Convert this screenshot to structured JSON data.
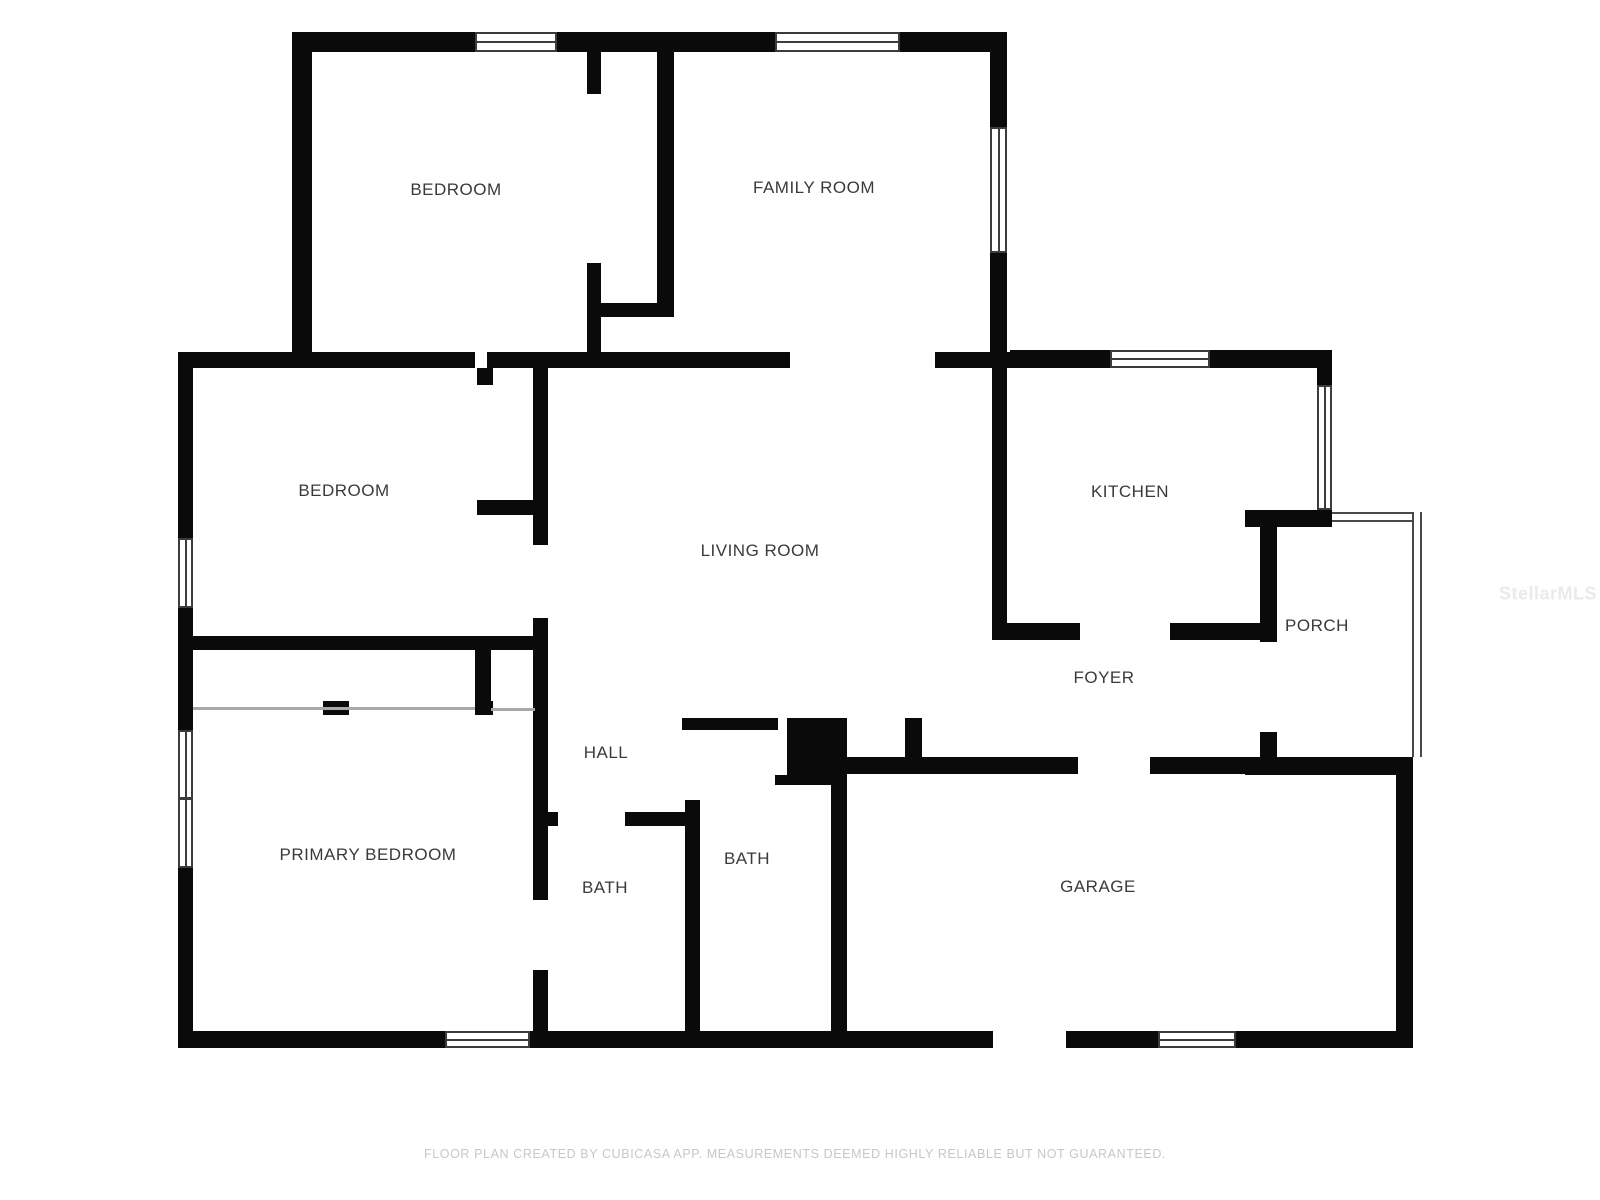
{
  "meta": {
    "app": "floor-plan",
    "creator_note": "FLOOR PLAN CREATED BY CUBICASA APP. MEASUREMENTS DEEMED HIGHLY RELIABLE BUT NOT GUARANTEED.",
    "watermark_text": "StellarMLS"
  },
  "colors": {
    "wall": "#0a0a0a",
    "window_outline": "#3c3c3c",
    "thin_line": "#a8a8a8",
    "label": "#3a3a3a",
    "footer": "#c7c7c7",
    "watermark": "#eaeaea",
    "background": "#ffffff"
  },
  "rooms": [
    {
      "id": "bedroom-top",
      "label": "BEDROOM",
      "cx": 456,
      "cy": 190
    },
    {
      "id": "family-room",
      "label": "FAMILY ROOM",
      "cx": 814,
      "cy": 188
    },
    {
      "id": "bedroom-mid",
      "label": "BEDROOM",
      "cx": 344,
      "cy": 491
    },
    {
      "id": "living-room",
      "label": "LIVING ROOM",
      "cx": 760,
      "cy": 551
    },
    {
      "id": "kitchen",
      "label": "KITCHEN",
      "cx": 1130,
      "cy": 492
    },
    {
      "id": "porch",
      "label": "PORCH",
      "cx": 1317,
      "cy": 626
    },
    {
      "id": "foyer",
      "label": "FOYER",
      "cx": 1104,
      "cy": 678
    },
    {
      "id": "hall",
      "label": "HALL",
      "cx": 606,
      "cy": 753
    },
    {
      "id": "primary-bedroom",
      "label": "PRIMARY BEDROOM",
      "cx": 368,
      "cy": 855
    },
    {
      "id": "bath-hall",
      "label": "BATH",
      "cx": 605,
      "cy": 888
    },
    {
      "id": "bath-center",
      "label": "BATH",
      "cx": 747,
      "cy": 859
    },
    {
      "id": "garage",
      "label": "GARAGE",
      "cx": 1098,
      "cy": 887
    }
  ],
  "walls": [
    {
      "x": 292,
      "y": 32,
      "w": 183,
      "h": 20
    },
    {
      "x": 557,
      "y": 32,
      "w": 218,
      "h": 20
    },
    {
      "x": 900,
      "y": 32,
      "w": 107,
      "h": 20
    },
    {
      "x": 292,
      "y": 32,
      "w": 20,
      "h": 330
    },
    {
      "x": 178,
      "y": 352,
      "w": 297,
      "h": 16
    },
    {
      "x": 487,
      "y": 352,
      "w": 303,
      "h": 16
    },
    {
      "x": 935,
      "y": 352,
      "w": 75,
      "h": 16
    },
    {
      "x": 1010,
      "y": 350,
      "w": 100,
      "h": 18
    },
    {
      "x": 1210,
      "y": 350,
      "w": 122,
      "h": 18
    },
    {
      "x": 178,
      "y": 352,
      "w": 15,
      "h": 186
    },
    {
      "x": 178,
      "y": 608,
      "w": 15,
      "h": 122
    },
    {
      "x": 178,
      "y": 868,
      "w": 15,
      "h": 180
    },
    {
      "x": 178,
      "y": 1031,
      "w": 267,
      "h": 17
    },
    {
      "x": 530,
      "y": 1031,
      "w": 463,
      "h": 17
    },
    {
      "x": 1066,
      "y": 1031,
      "w": 92,
      "h": 17
    },
    {
      "x": 1236,
      "y": 1031,
      "w": 177,
      "h": 17
    },
    {
      "x": 990,
      "y": 32,
      "w": 17,
      "h": 95
    },
    {
      "x": 990,
      "y": 253,
      "w": 17,
      "h": 115
    },
    {
      "x": 992,
      "y": 368,
      "w": 15,
      "h": 265
    },
    {
      "x": 1317,
      "y": 350,
      "w": 15,
      "h": 35
    },
    {
      "x": 1245,
      "y": 510,
      "w": 87,
      "h": 17
    },
    {
      "x": 992,
      "y": 623,
      "w": 88,
      "h": 17
    },
    {
      "x": 1170,
      "y": 623,
      "w": 93,
      "h": 17
    },
    {
      "x": 1260,
      "y": 522,
      "w": 17,
      "h": 120
    },
    {
      "x": 1260,
      "y": 732,
      "w": 17,
      "h": 26
    },
    {
      "x": 1245,
      "y": 757,
      "w": 168,
      "h": 18
    },
    {
      "x": 845,
      "y": 757,
      "w": 233,
      "h": 17
    },
    {
      "x": 1150,
      "y": 757,
      "w": 95,
      "h": 17
    },
    {
      "x": 831,
      "y": 718,
      "w": 16,
      "h": 313
    },
    {
      "x": 1396,
      "y": 757,
      "w": 17,
      "h": 274
    },
    {
      "x": 682,
      "y": 718,
      "w": 96,
      "h": 12
    },
    {
      "x": 787,
      "y": 718,
      "w": 46,
      "h": 57
    },
    {
      "x": 775,
      "y": 775,
      "w": 58,
      "h": 10
    },
    {
      "x": 905,
      "y": 718,
      "w": 17,
      "h": 39
    },
    {
      "x": 685,
      "y": 800,
      "w": 15,
      "h": 231
    },
    {
      "x": 548,
      "y": 812,
      "w": 10,
      "h": 14
    },
    {
      "x": 625,
      "y": 812,
      "w": 75,
      "h": 14
    },
    {
      "x": 533,
      "y": 368,
      "w": 15,
      "h": 177
    },
    {
      "x": 533,
      "y": 618,
      "w": 15,
      "h": 282
    },
    {
      "x": 533,
      "y": 970,
      "w": 15,
      "h": 61
    },
    {
      "x": 477,
      "y": 368,
      "w": 16,
      "h": 17
    },
    {
      "x": 477,
      "y": 500,
      "w": 68,
      "h": 15
    },
    {
      "x": 587,
      "y": 52,
      "w": 14,
      "h": 42
    },
    {
      "x": 587,
      "y": 263,
      "w": 14,
      "h": 89
    },
    {
      "x": 587,
      "y": 303,
      "w": 70,
      "h": 14
    },
    {
      "x": 657,
      "y": 42,
      "w": 17,
      "h": 275
    },
    {
      "x": 193,
      "y": 636,
      "w": 352,
      "h": 14
    },
    {
      "x": 475,
      "y": 650,
      "w": 16,
      "h": 65
    },
    {
      "x": 323,
      "y": 701,
      "w": 26,
      "h": 14
    },
    {
      "x": 475,
      "y": 701,
      "w": 18,
      "h": 14
    }
  ],
  "windows": [
    {
      "x": 475,
      "y": 32,
      "w": 82,
      "h": 20,
      "orient": "h",
      "divider": false
    },
    {
      "x": 775,
      "y": 32,
      "w": 125,
      "h": 20,
      "orient": "h",
      "divider": false
    },
    {
      "x": 1110,
      "y": 350,
      "w": 100,
      "h": 18,
      "orient": "h",
      "divider": false
    },
    {
      "x": 990,
      "y": 127,
      "w": 17,
      "h": 126,
      "orient": "v",
      "divider": false
    },
    {
      "x": 1317,
      "y": 385,
      "w": 15,
      "h": 125,
      "orient": "v",
      "divider": false
    },
    {
      "x": 178,
      "y": 538,
      "w": 15,
      "h": 70,
      "orient": "v",
      "divider": false
    },
    {
      "x": 178,
      "y": 730,
      "w": 15,
      "h": 138,
      "orient": "v",
      "divider": true
    },
    {
      "x": 445,
      "y": 1031,
      "w": 85,
      "h": 17,
      "orient": "h",
      "divider": false
    },
    {
      "x": 1158,
      "y": 1031,
      "w": 78,
      "h": 17,
      "orient": "h",
      "divider": false
    }
  ],
  "thin_lines": [
    {
      "x": 193,
      "y": 707,
      "w": 282,
      "h": 3
    },
    {
      "x": 491,
      "y": 708,
      "w": 44,
      "h": 3
    }
  ],
  "screen_bands": [
    {
      "x": 1332,
      "y": 512,
      "w": 90,
      "h": 10,
      "orient": "h"
    },
    {
      "x": 1412,
      "y": 512,
      "w": 10,
      "h": 245,
      "orient": "v"
    }
  ]
}
